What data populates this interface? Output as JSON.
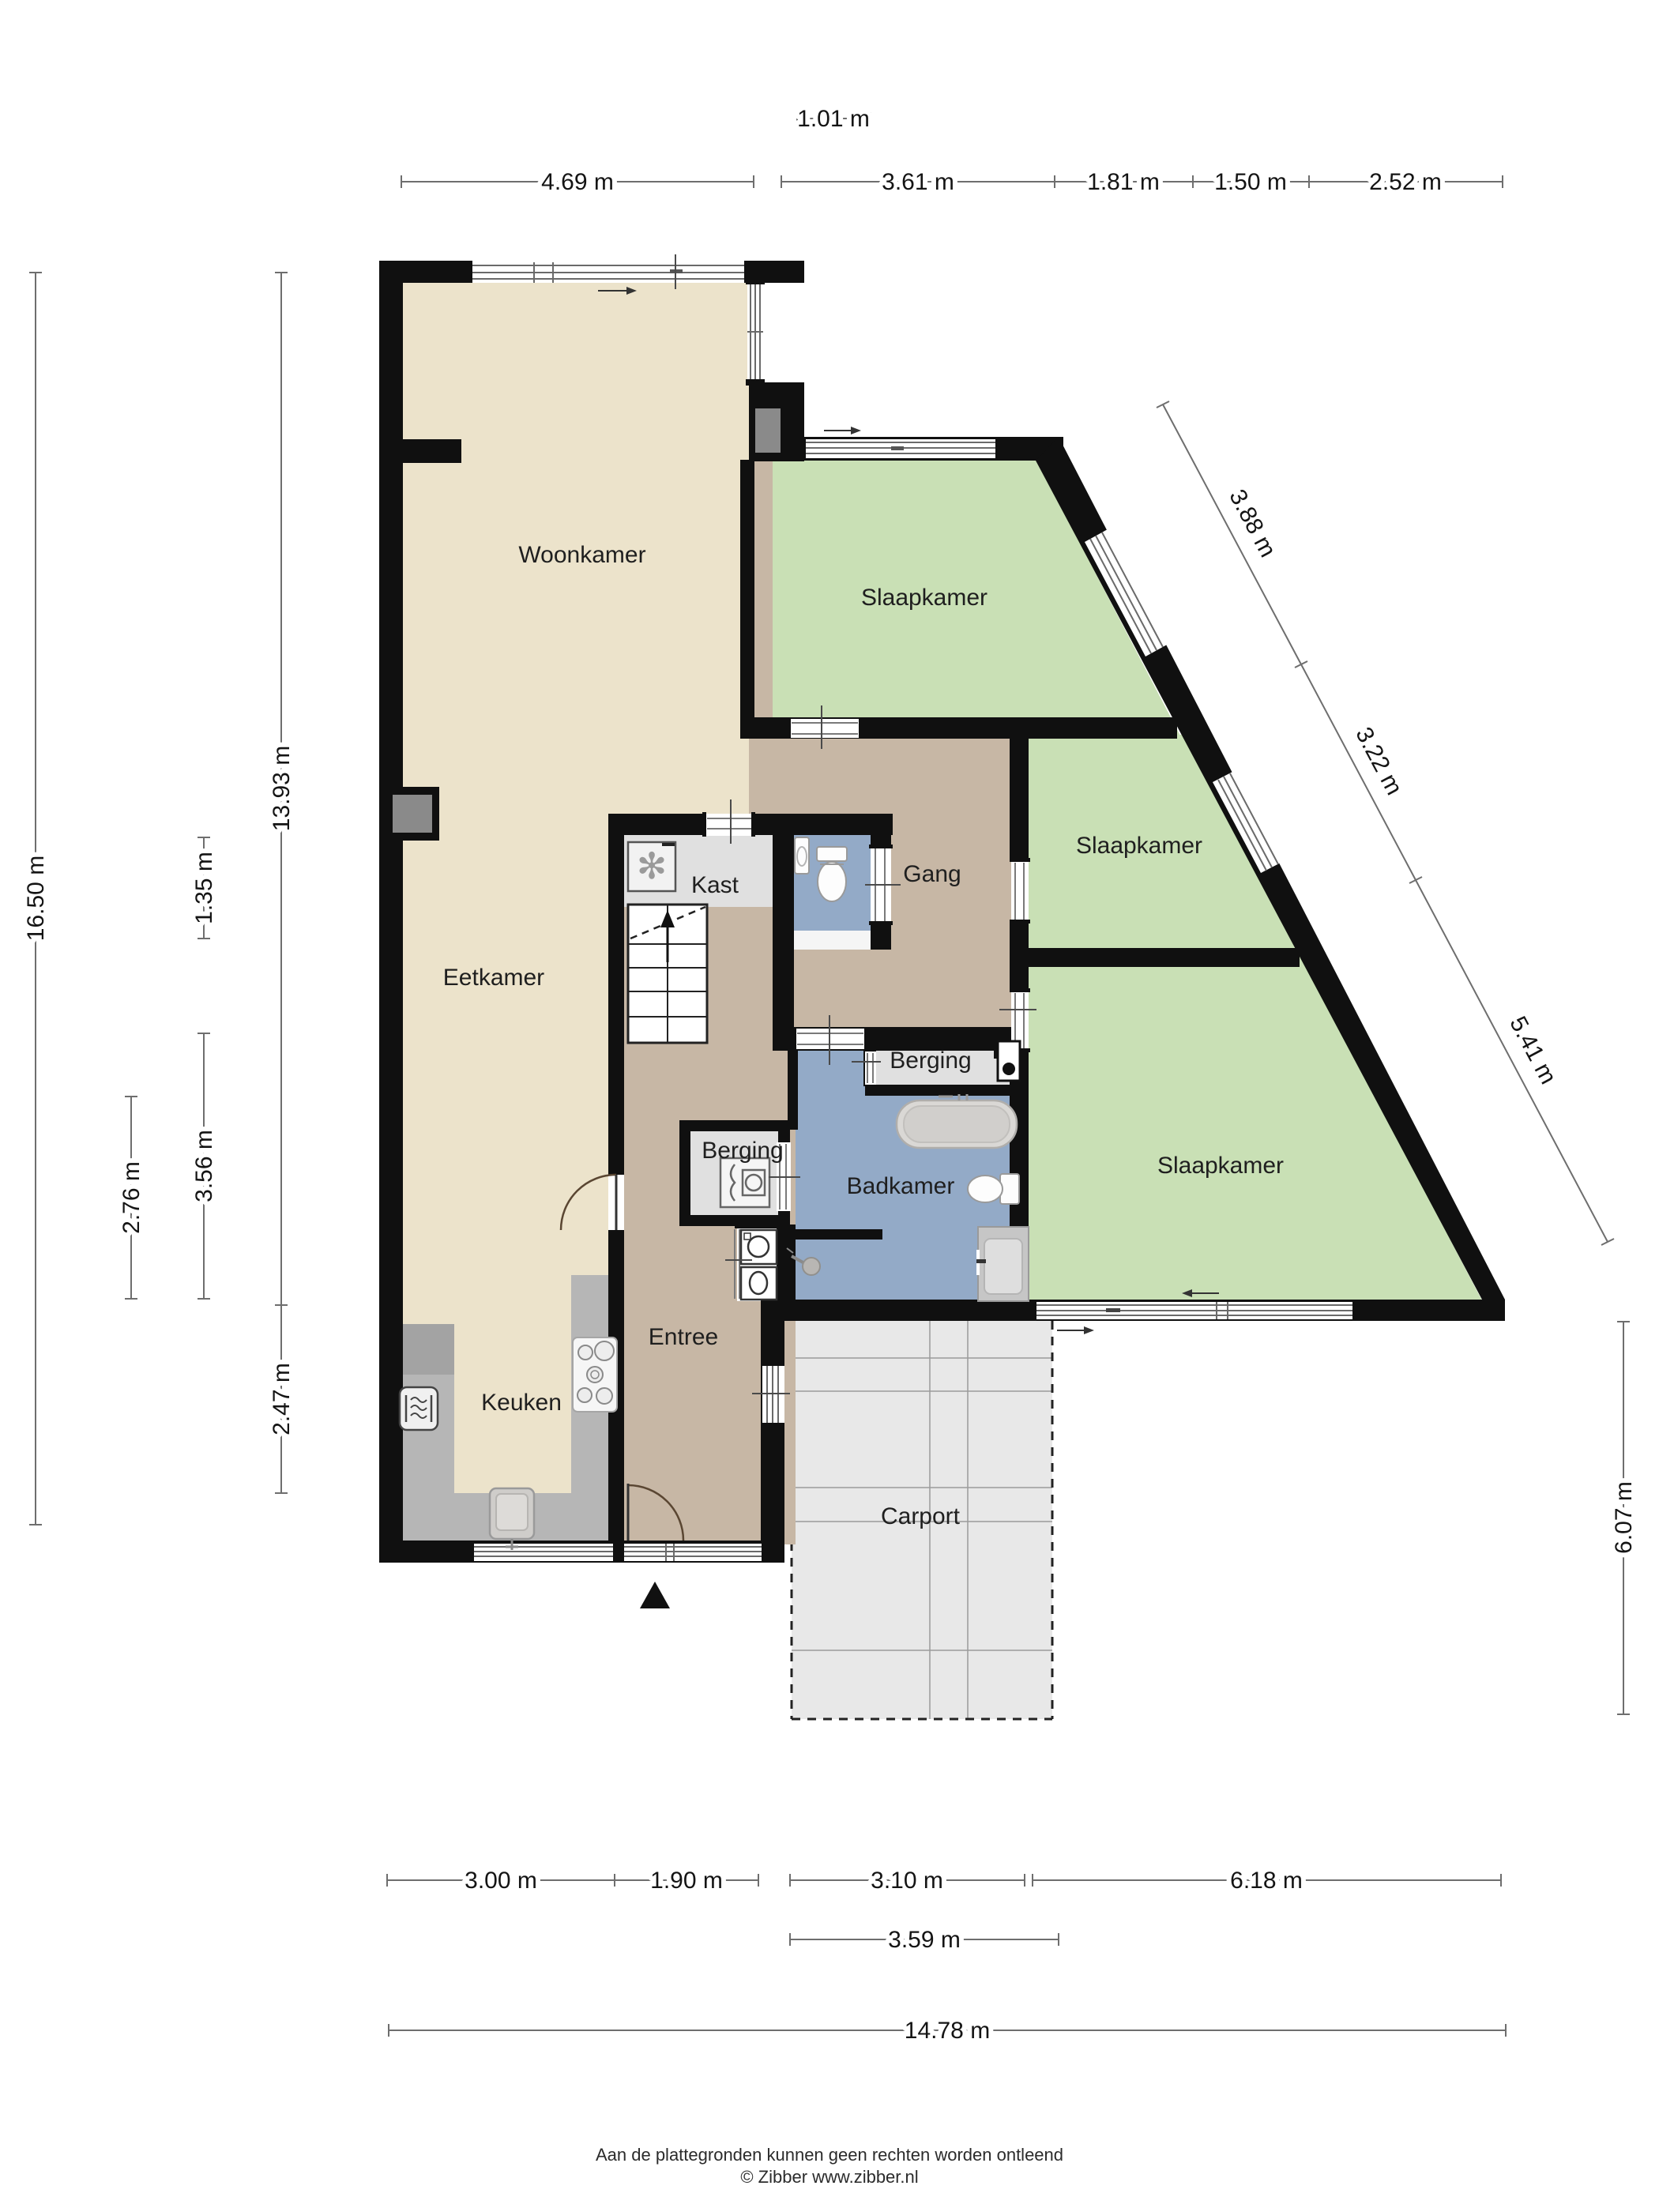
{
  "rooms": {
    "woonkamer": "Woonkamer",
    "eetkamer": "Eetkamer",
    "keuken": "Keuken",
    "entree": "Entree",
    "kast": "Kast",
    "gang": "Gang",
    "slaapkamer1": "Slaapkamer",
    "slaapkamer2": "Slaapkamer",
    "slaapkamer3": "Slaapkamer",
    "berging1": "Berging",
    "berging2": "Berging",
    "badkamer": "Badkamer",
    "carport": "Carport"
  },
  "dimensions": {
    "t0": "1.01 m",
    "t1": "4.69 m",
    "t2": "3.61 m",
    "t3": "1.81 m",
    "t4": "1.50 m",
    "t5": "2.52 m",
    "l1": "16.50 m",
    "l2": "2.76 m",
    "l3": "1.35 m",
    "l4": "3.56 m",
    "l5": "13.93 m",
    "l6": "2.47 m",
    "r1": "6.07 m",
    "d1": "3.88 m",
    "d2": "3.22 m",
    "d3": "5.41 m",
    "b1": "3.00 m",
    "b2": "1.90 m",
    "b3": "3.10 m",
    "b4": "6.18 m",
    "b5": "3.59 m",
    "b6": "14.78 m"
  },
  "footer": {
    "line1": "Aan de plattegronden kunnen geen rechten worden ontleend",
    "line2": "© Zibber www.zibber.nl"
  },
  "colors": {
    "living_floor": "#ece3cb",
    "hall_floor": "#c7b7a5",
    "bedroom_floor": "#c9e0b5",
    "bath_floor": "#93aac7",
    "storage_floor": "#e0e0e0",
    "counter": "#b6b6b6",
    "carport": "#e8e8e8",
    "wall": "#101010"
  }
}
